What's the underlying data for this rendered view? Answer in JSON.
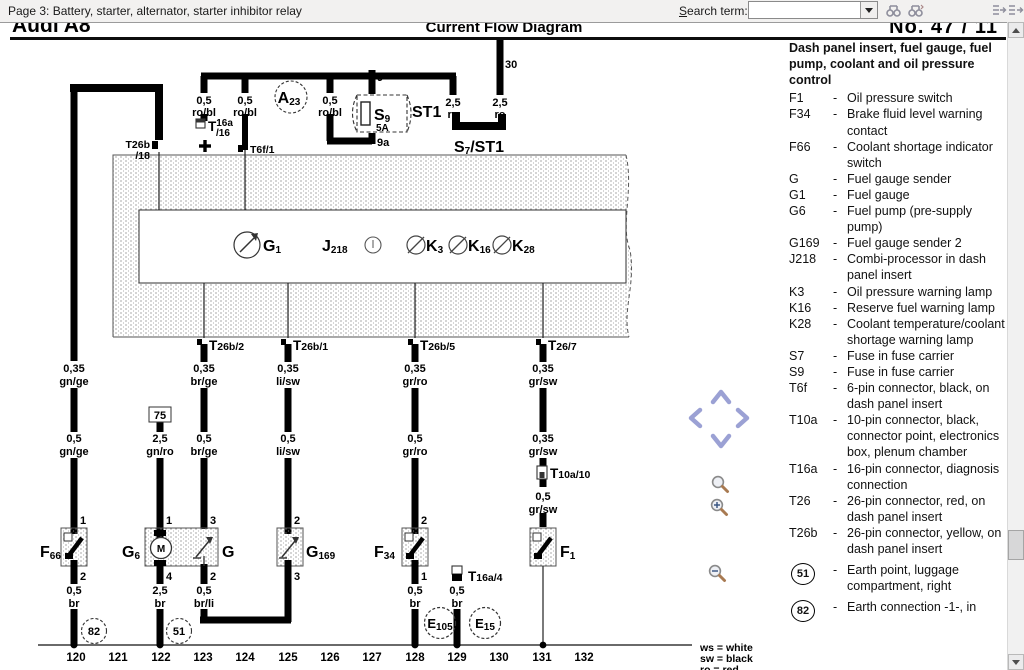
{
  "toolbar": {
    "page_info": "Page 3: Battery, starter, alternator, starter inhibitor relay",
    "search_label_accel": "S",
    "search_label_rest": "earch term:",
    "search_value": ""
  },
  "header": {
    "model": "Audi A8",
    "doc_type": "Current Flow Diagram",
    "number": "No. 47 / 11"
  },
  "panel": {
    "title": "Dash panel insert, fuel gauge, fuel pump, coolant and oil pressure control",
    "dash": "-",
    "items": [
      {
        "code": "F1",
        "desc": "Oil pressure switch"
      },
      {
        "code": "F34",
        "desc": "Brake fluid level warning contact"
      },
      {
        "code": "F66",
        "desc": "Coolant shortage indicator switch"
      },
      {
        "code": "G",
        "desc": "Fuel gauge sender"
      },
      {
        "code": "G1",
        "desc": "Fuel gauge"
      },
      {
        "code": "G6",
        "desc": "Fuel pump (pre-supply pump)"
      },
      {
        "code": "G169",
        "desc": "Fuel gauge sender 2"
      },
      {
        "code": "J218",
        "desc": "Combi-processor in dash panel insert"
      },
      {
        "code": "K3",
        "desc": "Oil pressure warning lamp"
      },
      {
        "code": "K16",
        "desc": "Reserve fuel warning lamp"
      },
      {
        "code": "K28",
        "desc": "Coolant temperature/coolant shortage warning lamp"
      },
      {
        "code": "S7",
        "desc": "Fuse in fuse carrier"
      },
      {
        "code": "S9",
        "desc": "Fuse in fuse carrier"
      },
      {
        "code": "T6f",
        "desc": "6-pin connector, black, on dash panel insert"
      },
      {
        "code": "T10a",
        "desc": "10-pin connector, black, connector point, electronics box, plenum chamber"
      },
      {
        "code": "T16a",
        "desc": "16-pin connector, diagnosis connection"
      },
      {
        "code": "T26",
        "desc": "26-pin connector, red, on dash panel insert"
      },
      {
        "code": "T26b",
        "desc": "26-pin connector, yellow, on dash panel insert"
      }
    ],
    "earth_items": [
      {
        "code": "51",
        "desc": "Earth point, luggage compartment, right"
      },
      {
        "code": "82",
        "desc": "Earth connection -1-, in"
      }
    ]
  },
  "color_key": {
    "l1": "ws = white",
    "l2": "sw = black",
    "l3": "ro = red"
  },
  "tracks": [
    "120",
    "121",
    "122",
    "123",
    "124",
    "125",
    "126",
    "127",
    "128",
    "129",
    "130",
    "131",
    "132"
  ],
  "wire": {
    "w035": "0,35",
    "w05": "0,5",
    "w25": "2,5",
    "robl": "ro/bl",
    "ro": "ro",
    "gnge": "gn/ge",
    "gnro": "gn/ro",
    "brge": "br/ge",
    "lisw": "li/sw",
    "grro": "gr/ro",
    "grsw": "gr/sw",
    "brli": "br/li",
    "br": "br"
  },
  "pin": {
    "p1": "1",
    "p2": "2",
    "p3": "3",
    "p4": "4",
    "p9": "9",
    "p9a": "9a",
    "p30": "30",
    "p75": "75"
  },
  "comp": {
    "a23": {
      "m": "A",
      "s": "23"
    },
    "s9": {
      "m": "S",
      "s": "9",
      "amp": "5A"
    },
    "st1": "ST1",
    "s7": {
      "m": "S",
      "s": "7",
      "rest": "/ST1"
    },
    "g1": {
      "m": "G",
      "s": "1"
    },
    "j218": {
      "m": "J",
      "s": "218"
    },
    "k3": {
      "m": "K",
      "s": "3"
    },
    "k16": {
      "m": "K",
      "s": "16"
    },
    "k28": {
      "m": "K",
      "s": "28"
    },
    "f66": {
      "m": "F",
      "s": "66"
    },
    "g6": {
      "m": "G",
      "s": "6"
    },
    "g": "G",
    "g169": {
      "m": "G",
      "s": "169"
    },
    "f34": {
      "m": "F",
      "s": "34"
    },
    "f1": {
      "m": "F",
      "s": "1"
    },
    "e105": {
      "m": "E",
      "s": "105"
    },
    "e15": {
      "m": "E",
      "s": "15"
    },
    "motor": "M",
    "e51": "51",
    "e82": "82"
  },
  "conn": {
    "t26b18_top": "T26b",
    "t26b18_bot": "/18",
    "t16a16": {
      "m": "T",
      "sup": "16a",
      "sub": "/16"
    },
    "t6f1": "T6f/1",
    "t26b2": {
      "m": "T",
      "s": "26b/2"
    },
    "t26b1": {
      "m": "T",
      "s": "26b/1"
    },
    "t26b5": {
      "m": "T",
      "s": "26b/5"
    },
    "t267": {
      "m": "T",
      "s": "26/7"
    },
    "t10a10": {
      "m": "T",
      "s": "10a/10"
    },
    "t16a4": {
      "m": "T",
      "s": "16a/4"
    }
  }
}
